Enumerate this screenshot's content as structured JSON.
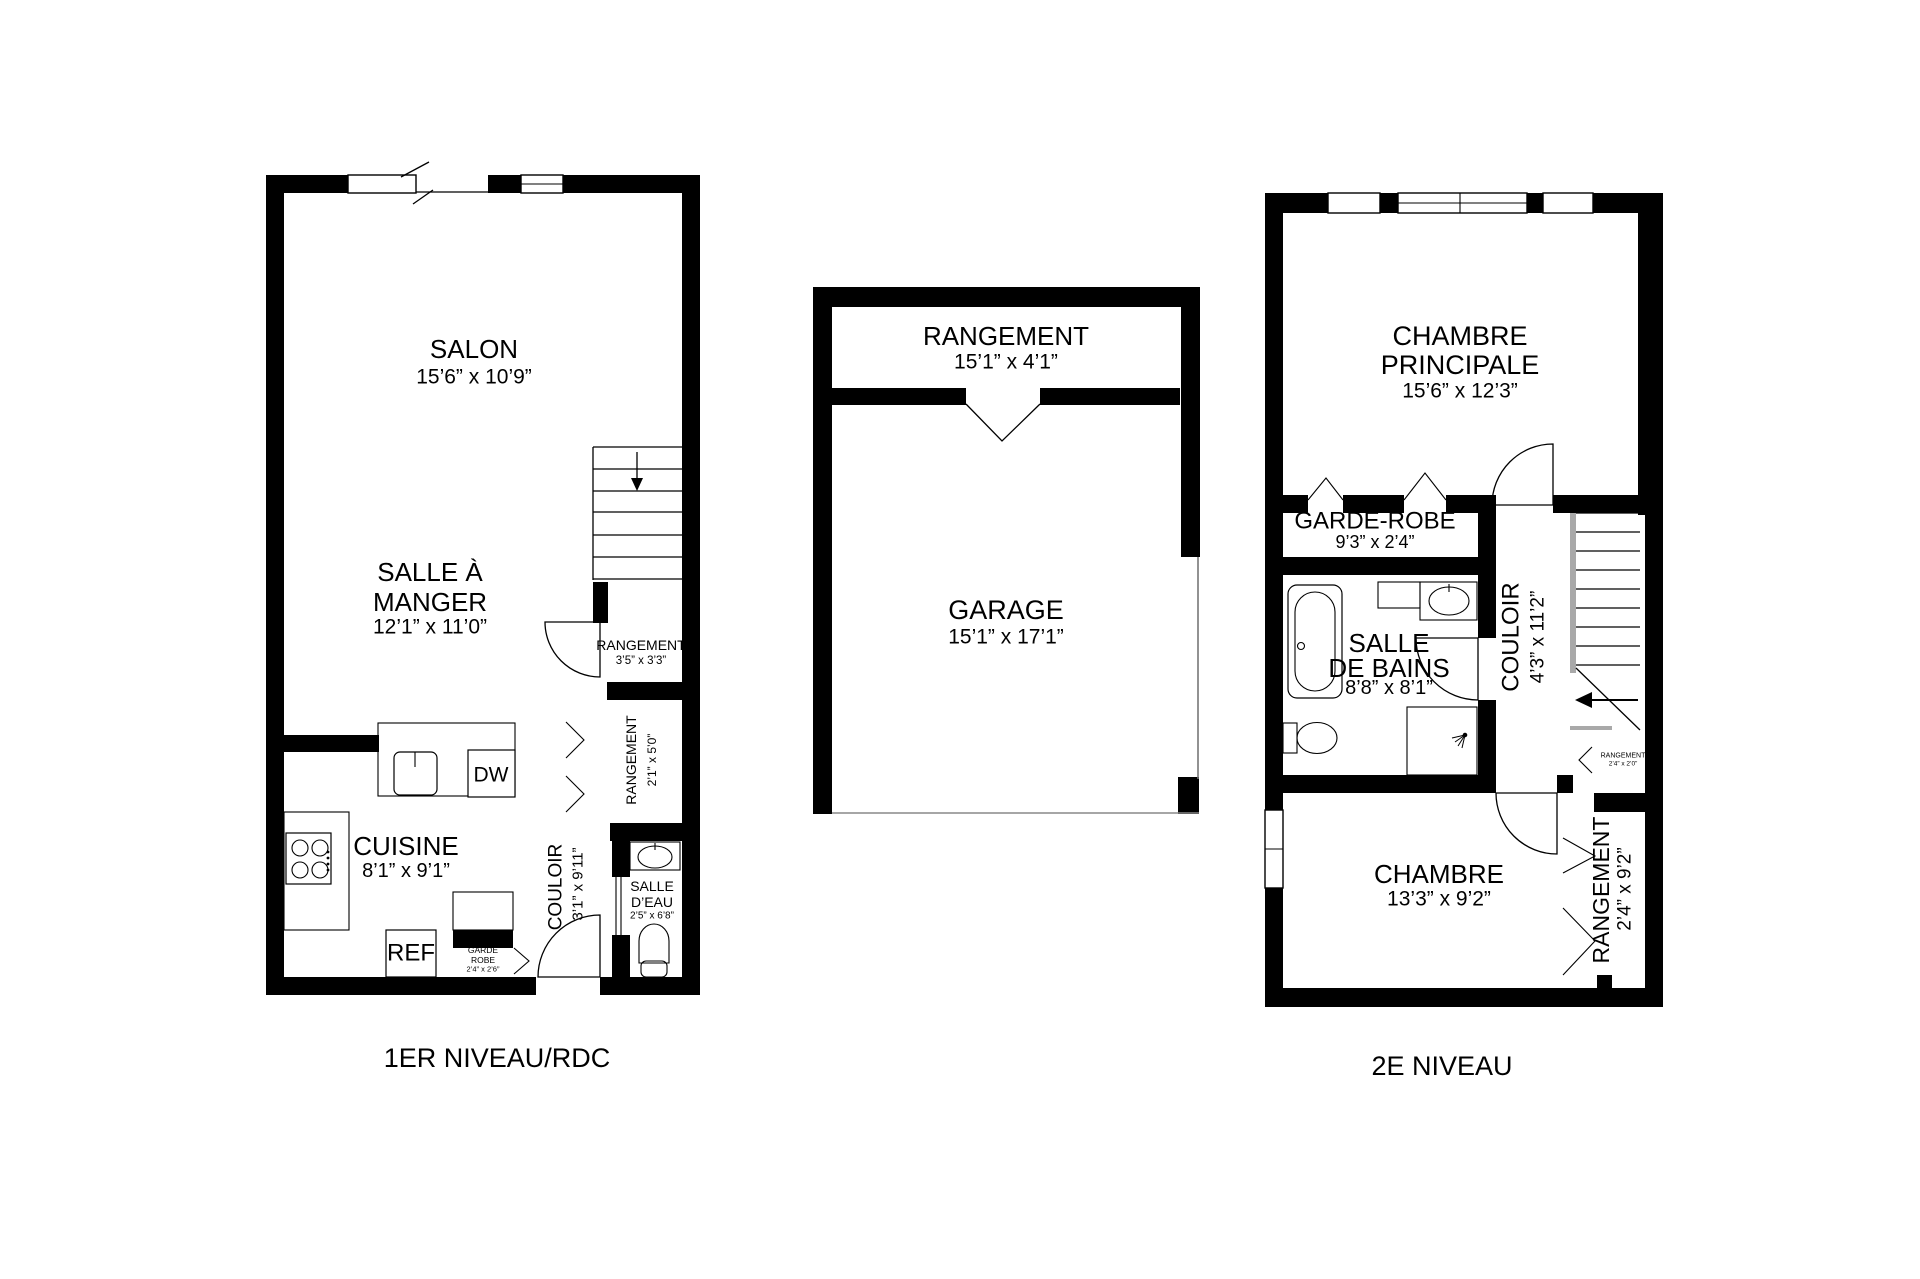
{
  "style": {
    "wall_color": "#000000",
    "background": "#ffffff",
    "stair_gray": "#a9a9a9"
  },
  "floor1": {
    "title": "1ER NIVEAU/RDC",
    "rooms": {
      "salon": {
        "name": "SALON",
        "dims": "15’6” x 10’9”"
      },
      "salle_a_manger": {
        "name_line1": "SALLE À",
        "name_line2": "MANGER",
        "dims": "12’1” x 11’0”"
      },
      "cuisine": {
        "name": "CUISINE",
        "dims": "8’1” x 9’1”"
      },
      "couloir": {
        "name": "COULOIR",
        "dims": "3’1” x 9’11”"
      },
      "salle_deau": {
        "name_line1": "SALLE",
        "name_line2": "D’EAU",
        "dims": "2’5” x 6’8”"
      },
      "rangement_understairs": {
        "name": "RANGEMENT",
        "dims": "3’5” x 3’3”"
      },
      "rangement_hall": {
        "name": "RANGEMENT",
        "dims": "2’1” x 5’0”"
      },
      "garde_robe": {
        "name_line1": "GARDE",
        "name_line2": "ROBE",
        "dims": "2’4” x 2’6”"
      },
      "ref": "REF",
      "dw": "DW"
    }
  },
  "garage_plan": {
    "rangement": {
      "name": "RANGEMENT",
      "dims": "15’1” x 4’1”"
    },
    "garage": {
      "name": "GARAGE",
      "dims": "15’1” x 17’1”"
    }
  },
  "floor2": {
    "title": "2E NIVEAU",
    "rooms": {
      "chambre_principale": {
        "name_line1": "CHAMBRE",
        "name_line2": "PRINCIPALE",
        "dims": "15’6” x 12’3”"
      },
      "garde_robe": {
        "name": "GARDE-ROBE",
        "dims": "9’3” x 2’4”"
      },
      "salle_de_bains": {
        "name_line1": "SALLE",
        "name_line2": "DE BAINS",
        "dims": "8’8” x 8’1”"
      },
      "couloir": {
        "name": "COULOIR",
        "dims": "4’3” x 11’2”"
      },
      "chambre": {
        "name": "CHAMBRE",
        "dims": "13’3” x 9’2”"
      },
      "rangement_chambre": {
        "name": "RANGEMENT",
        "dims": "2’4” x 9’2”"
      },
      "rangement_understairs": {
        "name": "RANGEMENT",
        "dims": "2’4” x 2’0”"
      }
    }
  }
}
